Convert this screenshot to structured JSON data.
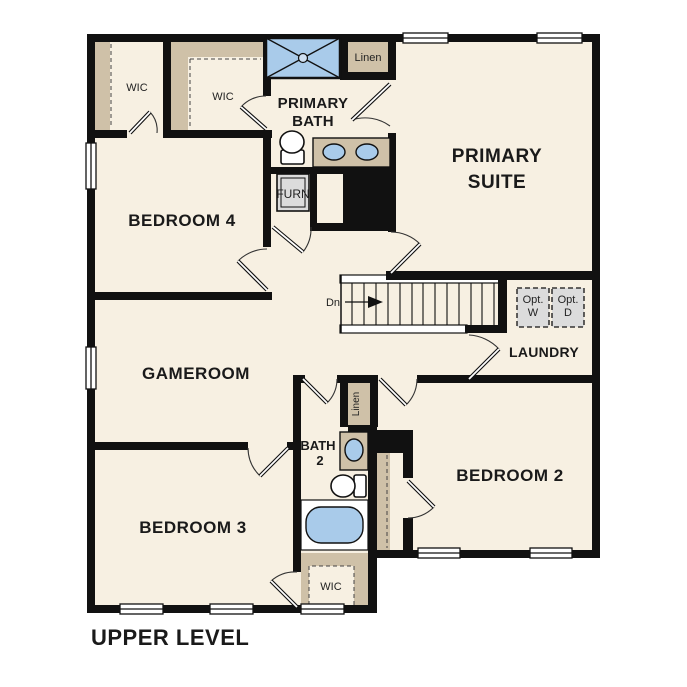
{
  "floor_title": "UPPER LEVEL",
  "rooms": {
    "primary_suite": {
      "line1": "PRIMARY",
      "line2": "SUITE"
    },
    "primary_bath": {
      "line1": "PRIMARY",
      "line2": "BATH"
    },
    "bedroom_4": {
      "label": "BEDROOM 4"
    },
    "bedroom_3": {
      "label": "BEDROOM 3"
    },
    "bedroom_2": {
      "label": "BEDROOM 2"
    },
    "gameroom": {
      "label": "GAMEROOM"
    },
    "laundry": {
      "label": "LAUNDRY"
    },
    "bath_2": {
      "line1": "BATH",
      "line2": "2"
    }
  },
  "closets": {
    "wic_bedroom4": "WIC",
    "wic_primary": "WIC",
    "wic_bedroom3": "WIC",
    "linen_upper": "Linen",
    "linen_lower": "Linen"
  },
  "utility": {
    "furnace": "FURN",
    "opt_washer_line1": "Opt.",
    "opt_washer_line2": "W",
    "opt_dryer_line1": "Opt.",
    "opt_dryer_line2": "D"
  },
  "stairs": {
    "direction": "Dn"
  },
  "colors": {
    "floor": "#f7f0e2",
    "closet_tan": "#cfc1a8",
    "fixture_blue": "#a9cbea",
    "utility_gray": "#dcdcdc",
    "wall_black": "#111111",
    "background": "#ffffff"
  }
}
